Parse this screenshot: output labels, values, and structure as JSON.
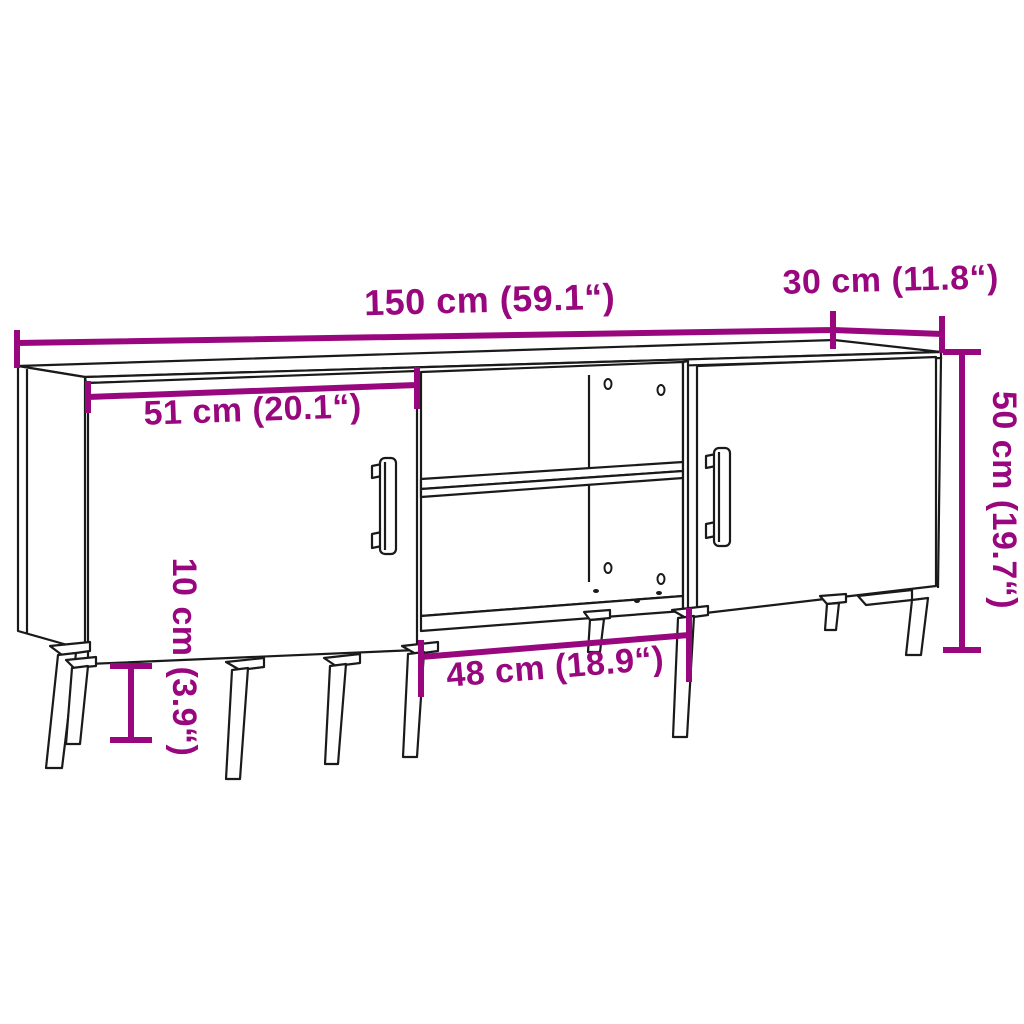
{
  "figure": {
    "subject": "TV cabinet line drawing with two doors, open middle compartment with shelf, and metal legs",
    "style": "technical dimension diagram"
  },
  "colors": {
    "accent": "#98077E",
    "line": "#1a1a1a",
    "background": "#ffffff"
  },
  "dimensions": {
    "width": {
      "label": "150 cm (59.1“)",
      "value_cm": 150,
      "value_inch": 59.1
    },
    "depth": {
      "label": "30 cm (11.8“)",
      "value_cm": 30,
      "value_inch": 11.8
    },
    "height": {
      "label": "50 cm (19.7“)",
      "value_cm": 50,
      "value_inch": 19.7
    },
    "door_width": {
      "label": "51 cm (20.1“)",
      "value_cm": 51,
      "value_inch": 20.1
    },
    "leg_height": {
      "label": "10 cm (3.9“)",
      "value_cm": 10,
      "value_inch": 3.9
    },
    "compartment_width": {
      "label": "48 cm (18.9“)",
      "value_cm": 48,
      "value_inch": 18.9
    }
  }
}
